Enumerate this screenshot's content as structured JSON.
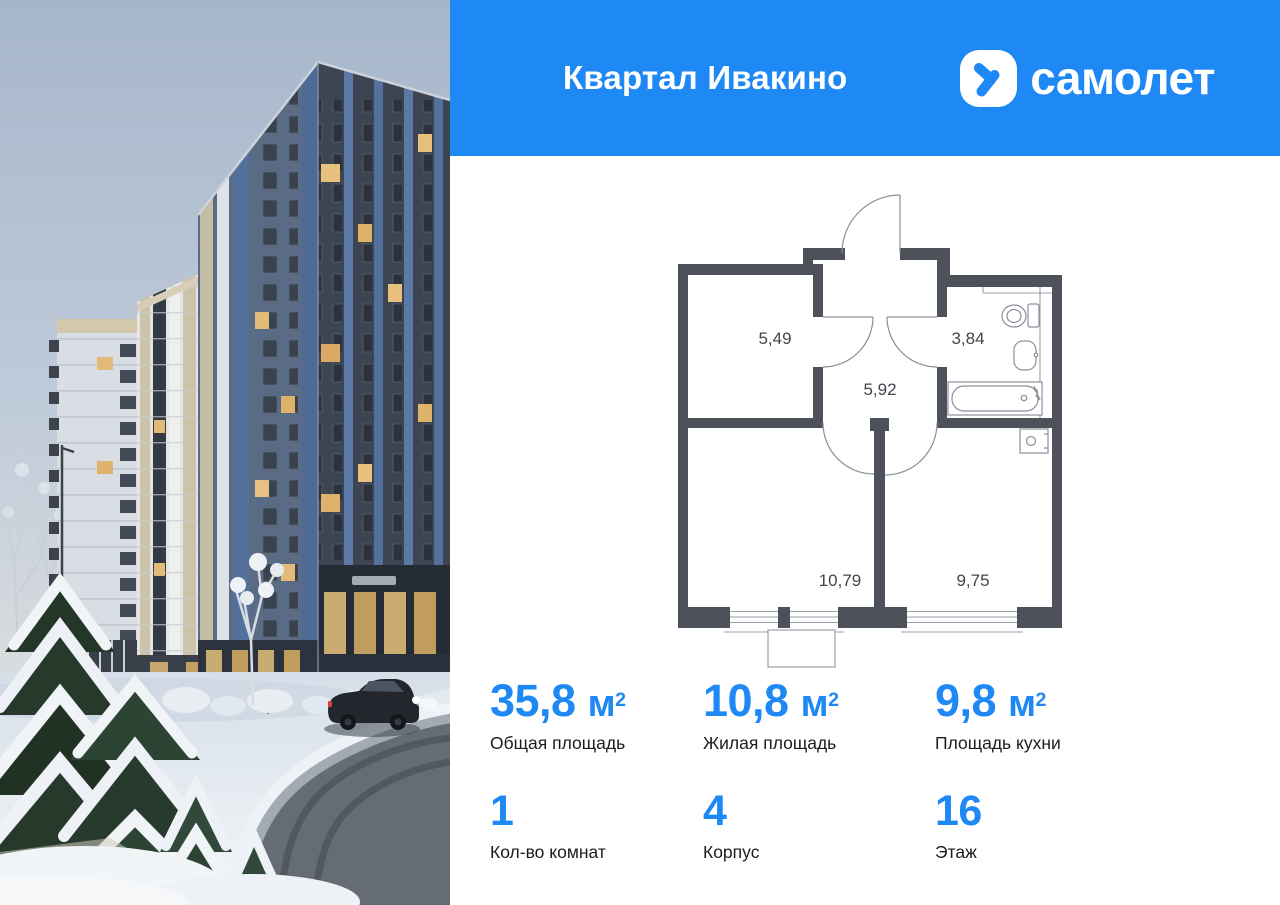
{
  "colors": {
    "accent": "#1e88f5",
    "wall": "#4c515a"
  },
  "header": {
    "title": "Квартал Ивакино",
    "brand": "самолет"
  },
  "photo": {
    "alt": "Зимний вид жилого квартала: многоэтажные дома, заснеженные ели, дорога и автомобиль"
  },
  "floor_plan": {
    "areas": {
      "storage": "5,49",
      "hallway": "5,92",
      "bathroom": "3,84",
      "living_room": "10,79",
      "kitchen": "9,75"
    }
  },
  "stats": [
    {
      "value": "35,8",
      "unit_base": "м",
      "unit_sup": "2",
      "label": "Общая площадь"
    },
    {
      "value": "10,8",
      "unit_base": "м",
      "unit_sup": "2",
      "label": "Жилая площадь"
    },
    {
      "value": "9,8",
      "unit_base": "м",
      "unit_sup": "2",
      "label": "Площадь кухни"
    },
    {
      "value": "1",
      "label": "Кол-во комнат"
    },
    {
      "value": "4",
      "label": "Корпус"
    },
    {
      "value": "16",
      "label": "Этаж"
    }
  ]
}
